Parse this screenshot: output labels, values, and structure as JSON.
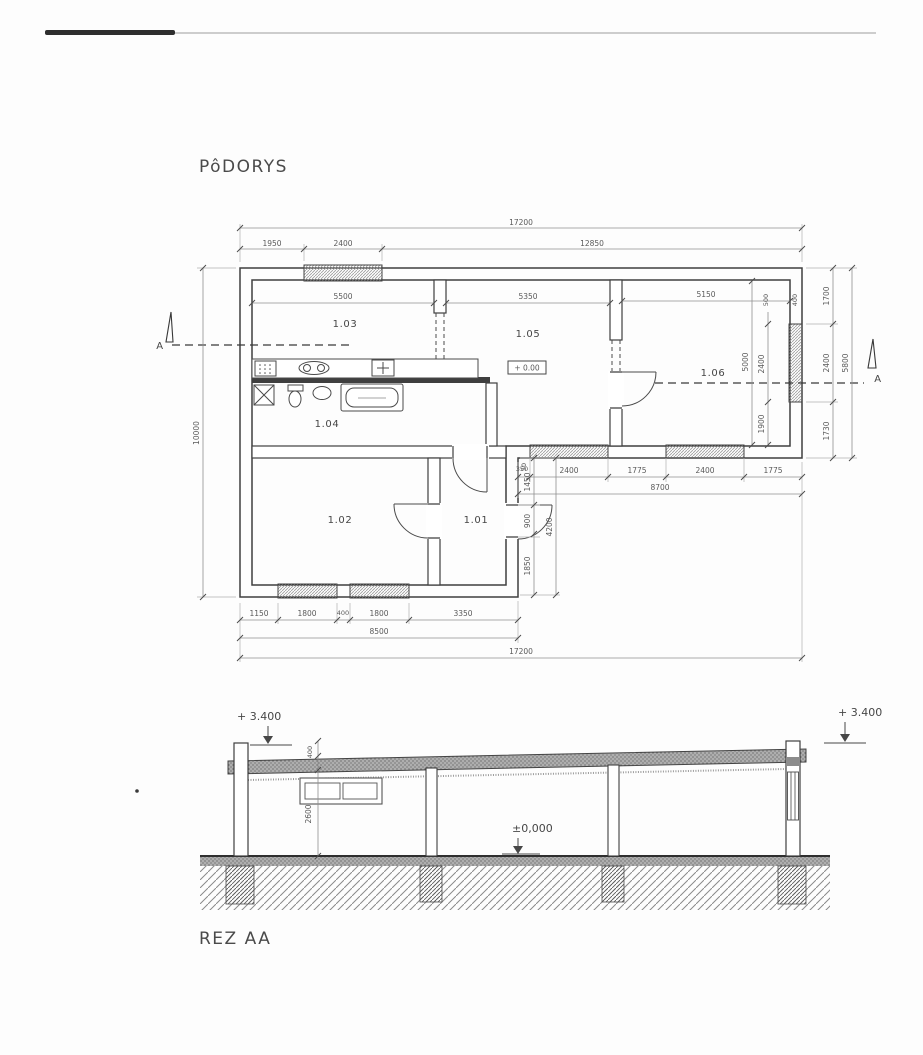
{
  "titles": {
    "plan": "PôDORYS",
    "section": "REZ AA"
  },
  "plan": {
    "marker_a": "A",
    "level_marker": "+ 0.00",
    "rooms": {
      "r103": "1.03",
      "r104": "1.04",
      "r105": "1.05",
      "r106": "1.06",
      "r102": "1.02",
      "r101": "1.01"
    },
    "dims": {
      "top_total": "17200",
      "top_seg": [
        "1950",
        "2400",
        "12850"
      ],
      "left_total": "10000",
      "right_seg": [
        "1700",
        "2400",
        "1730"
      ],
      "right_total": "5800",
      "room_widths": [
        "5500",
        "5350",
        "5150"
      ],
      "inner106": {
        "height": "5000",
        "top1": "500",
        "top2": "400",
        "win": "2400",
        "below": "1900"
      },
      "mid_seg": [
        "350",
        "2400",
        "1775",
        "2400",
        "1775"
      ],
      "mid_total": "8700",
      "notch_small": "50",
      "notch_seg": [
        "1450",
        "900",
        "1850"
      ],
      "notch_total": "4200",
      "bottom_seg": [
        "1150",
        "1800",
        "400",
        "1800",
        "3350"
      ],
      "bottom_sub": "8500",
      "bottom_total": "17200"
    }
  },
  "section": {
    "levels": {
      "left": "+ 3.400",
      "right": "+ 3.400",
      "zero": "±0,000"
    },
    "dims": {
      "roof": "400",
      "height": "2600"
    }
  }
}
